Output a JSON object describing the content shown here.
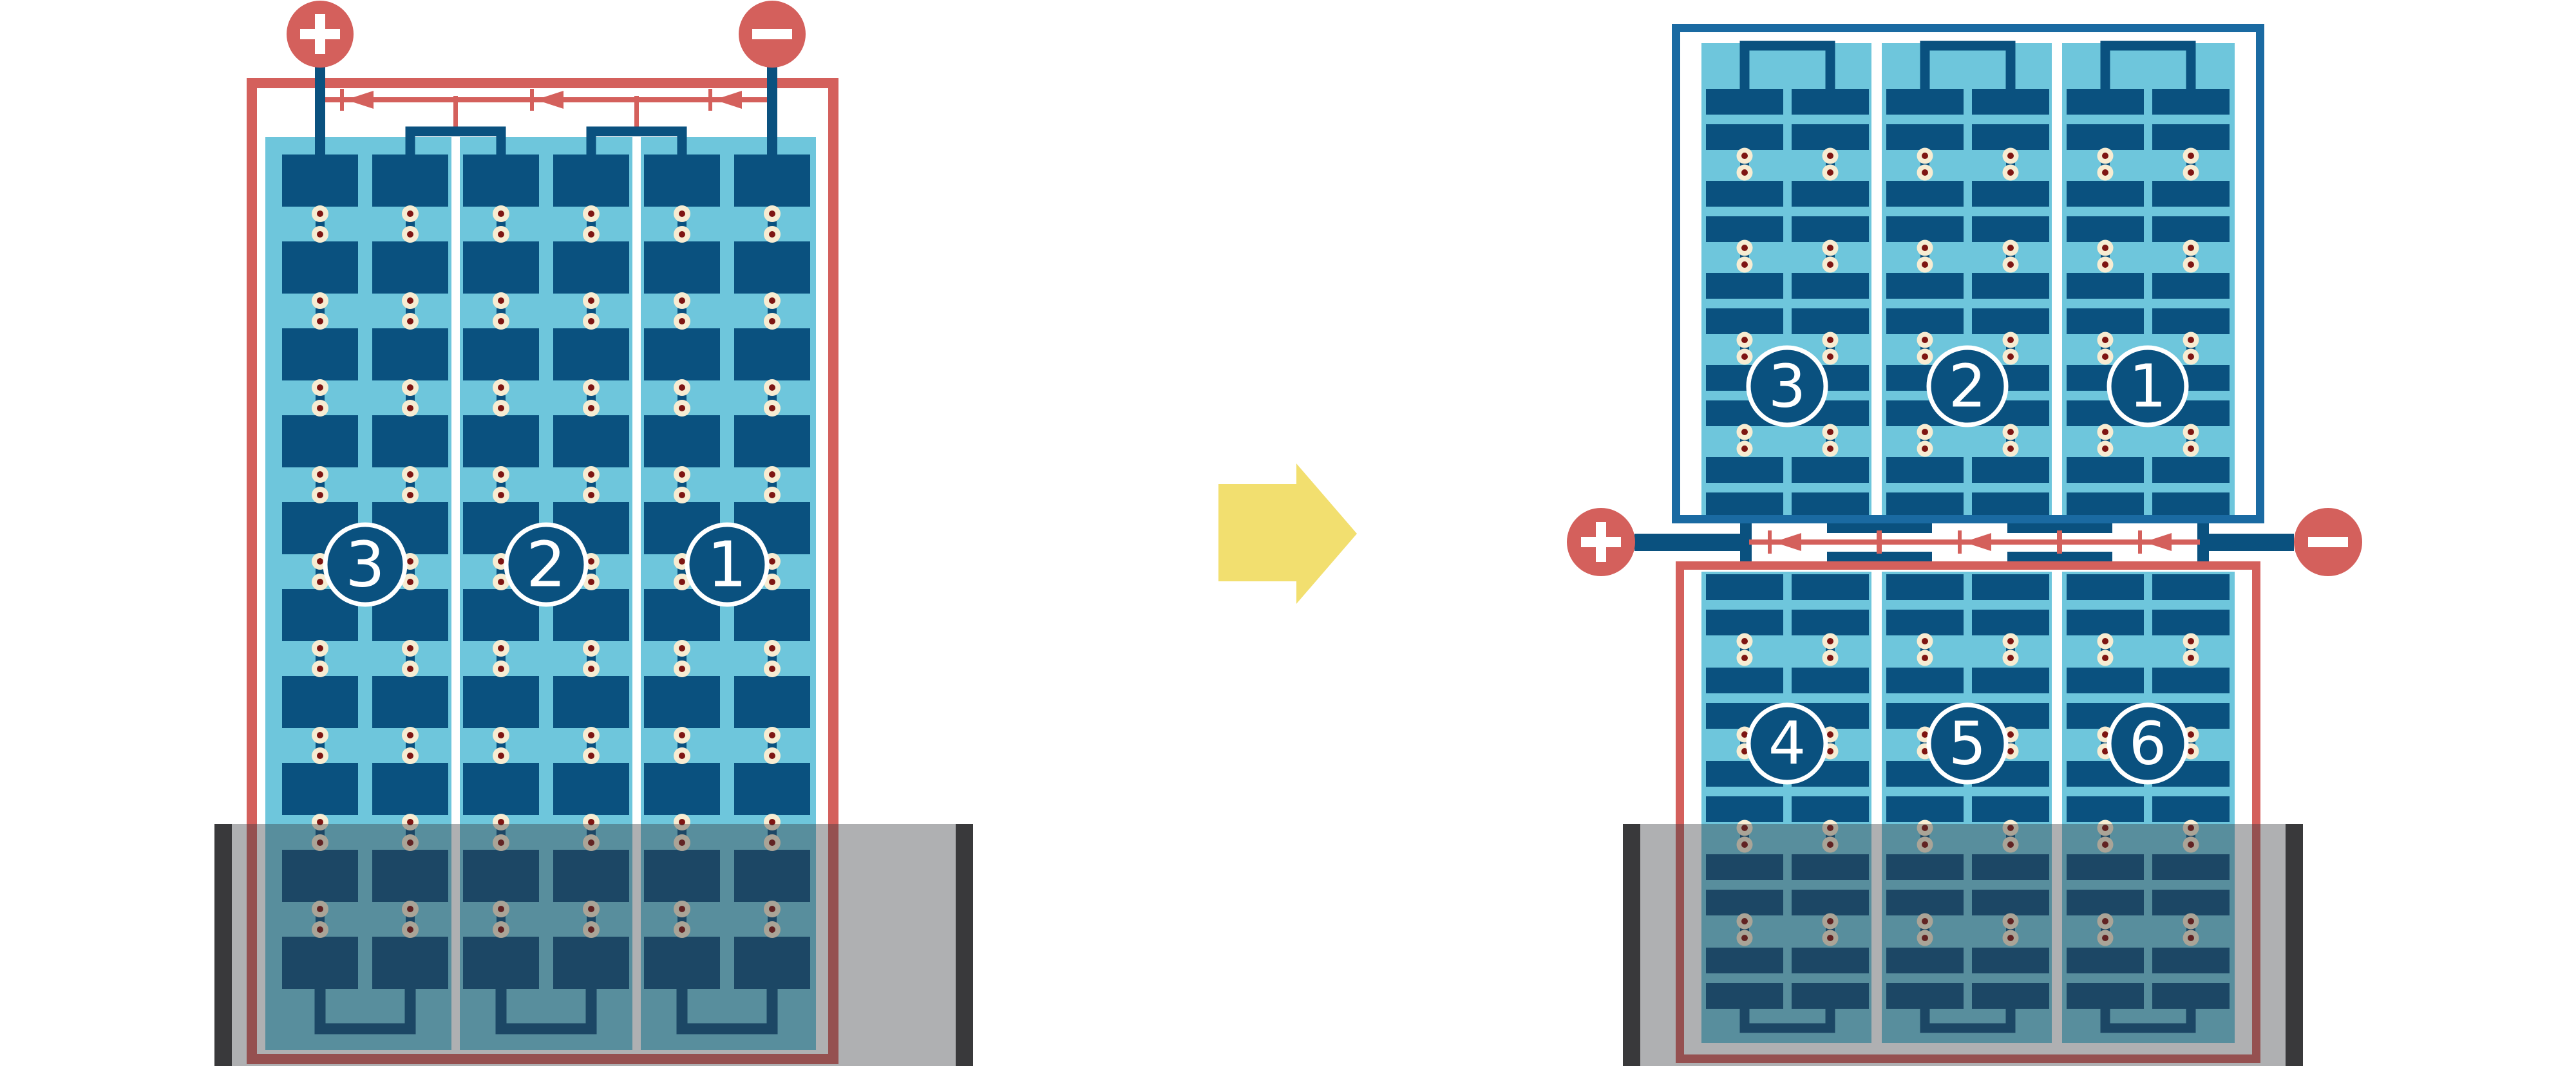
{
  "colors": {
    "background": "#FFFFFF",
    "accent_red": "#D4605C",
    "cell_navy": "#0A517F",
    "frame_blue": "#1A6AA2",
    "panel_sky": "#6EC6DC",
    "solder_cream": "#F7ECD2",
    "solder_maroon": "#7E1512",
    "arrow_yellow": "#F2DF6F",
    "shade_overlay": "rgba(55,58,62,0.40)",
    "shade_bar": "#39393B"
  },
  "left_diagram": {
    "terminals": {
      "positive": {
        "symbol": "+"
      },
      "negative": {
        "symbol": "−"
      }
    },
    "strings": [
      {
        "label": "3"
      },
      {
        "label": "2"
      },
      {
        "label": "1"
      }
    ],
    "bypass_diode_count": 3,
    "shaded_bottom": true
  },
  "arrow": {
    "direction": "right"
  },
  "right_diagram": {
    "terminals": {
      "positive": {
        "symbol": "+"
      },
      "negative": {
        "symbol": "−"
      }
    },
    "top_half": {
      "strings": [
        {
          "label": "3"
        },
        {
          "label": "2"
        },
        {
          "label": "1"
        }
      ]
    },
    "bottom_half": {
      "strings": [
        {
          "label": "4"
        },
        {
          "label": "5"
        },
        {
          "label": "6"
        }
      ]
    },
    "bypass_diode_count": 3,
    "shaded_bottom": true
  }
}
